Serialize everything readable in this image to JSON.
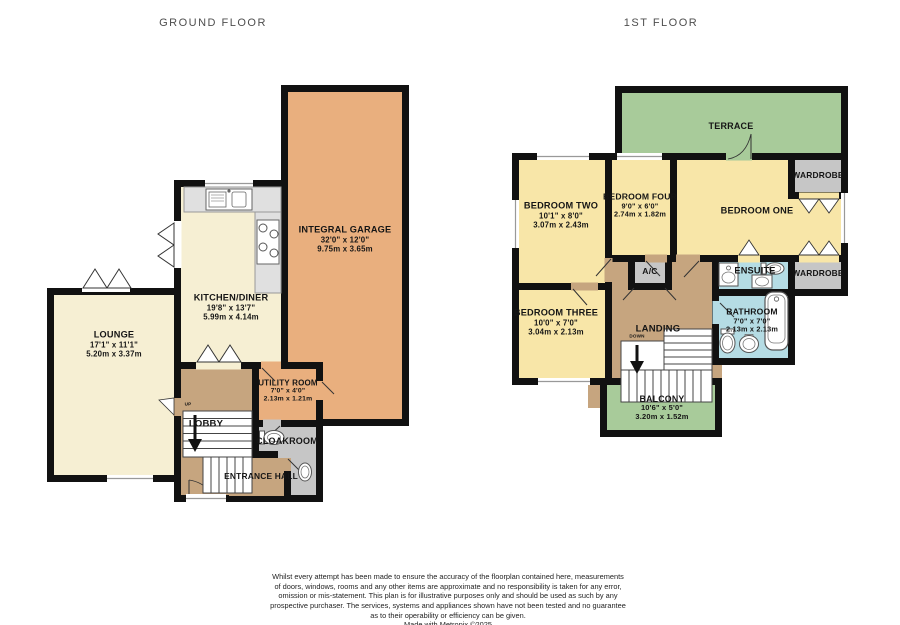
{
  "floor_titles": {
    "ground": "GROUND FLOOR",
    "first": "1ST FLOOR"
  },
  "ground": {
    "garage": {
      "name": "INTEGRAL GARAGE",
      "imperial": "32'0\" x 12'0\"",
      "metric": "9.75m x 3.65m"
    },
    "kitchen": {
      "name": "KITCHEN/DINER",
      "imperial": "19'8\" x 13'7\"",
      "metric": "5.99m x 4.14m"
    },
    "lounge": {
      "name": "LOUNGE",
      "imperial": "17'1\" x 11'1\"",
      "metric": "5.20m x 3.37m"
    },
    "utility": {
      "name": "UTILITY ROOM",
      "imperial": "7'0\" x 4'0\"",
      "metric": "2.13m x 1.21m"
    },
    "lobby": {
      "name": "LOBBY"
    },
    "cloakroom": {
      "name": "CLOAKROOM"
    },
    "entrance": {
      "name": "ENTRANCE HALL"
    },
    "stair_label": "UP"
  },
  "first": {
    "terrace": {
      "name": "TERRACE"
    },
    "bedroom_two": {
      "name": "BEDROOM TWO",
      "imperial": "10'1\" x 8'0\"",
      "metric": "3.07m x 2.43m"
    },
    "bedroom_four": {
      "name": "BEDROOM FOUR",
      "imperial": "9'0\" x 6'0\"",
      "metric": "2.74m x 1.82m"
    },
    "bedroom_one": {
      "name": "BEDROOM ONE"
    },
    "bedroom_three": {
      "name": "BEDROOM THREE",
      "imperial": "10'0\" x 7'0\"",
      "metric": "3.04m x 2.13m"
    },
    "wardrobe_top": {
      "name": "WARDROBE"
    },
    "wardrobe_bottom": {
      "name": "WARDROBE"
    },
    "ac": {
      "name": "A/C"
    },
    "ensuite": {
      "name": "ENSUITE"
    },
    "bathroom": {
      "name": "BATHROOM",
      "imperial": "7'0\" x 7'0\"",
      "metric": "2.13m x 2.13m"
    },
    "landing": {
      "name": "LANDING"
    },
    "stair_label": "DOWN",
    "balcony": {
      "name": "BALCONY",
      "imperial": "10'6\" x 5'0\"",
      "metric": "3.20m x 1.52m"
    }
  },
  "footer": {
    "disclaimer": [
      "Whilst every attempt has been made to ensure the accuracy of the floorplan contained here, measurements",
      "of doors, windows, rooms and any other items are approximate and no responsibility is taken for any error,",
      "omission or mis-statement. This plan is for illustrative purposes only and should be used as such by any",
      "prospective purchaser. The services, systems and appliances shown have not been tested and no guarantee",
      "as to their operability or efficiency can be given.",
      "Made with Metropix ©2025"
    ]
  },
  "colors": {
    "wall": "#111111",
    "cream_room": "#F6EFD3",
    "bedroom_yellow": "#F8E6A8",
    "garage_orange": "#E9AF7E",
    "hall_brown": "#C6A57F",
    "outdoor_green": "#A8CB9A",
    "bathroom_blue": "#B5DCE4",
    "storage_gray": "#C6C6C6",
    "counter_gray": "#E0E0E0"
  }
}
